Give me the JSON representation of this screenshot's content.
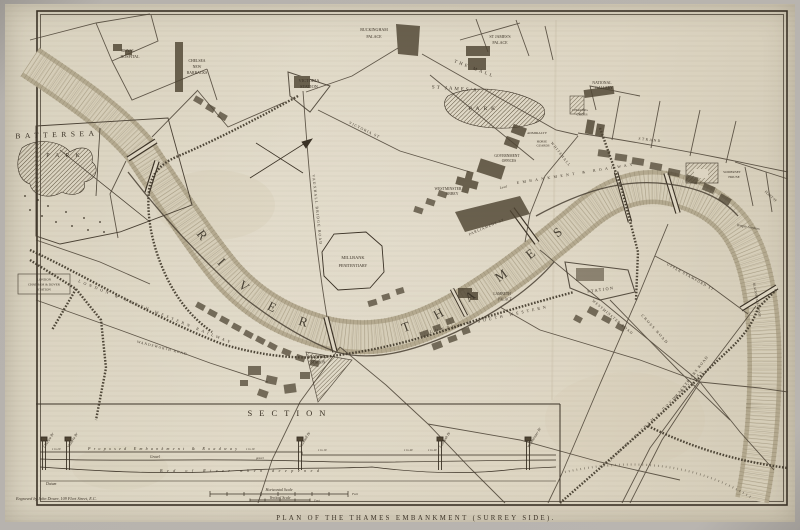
{
  "figure": {
    "caption": "PLAN OF THE THAMES EMBANKMENT (SURREY SIDE).",
    "credit": "Engraved by John Dower, 109 Fleet Street, E.C.",
    "colors": {
      "paper": "#ddd5c2",
      "ink": "#3b3226",
      "river_channel": "#d5cdb8",
      "river_bank": "#b1a68c",
      "photo_border": "#b6b2ad"
    }
  },
  "map": {
    "river_label": "RIVER THAMES",
    "labels": {
      "battersea": "BATTERSEA",
      "battersea_park": "PARK",
      "royal_hospital": [
        "ROYAL",
        "HOSPITAL"
      ],
      "chelsea_barracks": [
        "CHELSEA",
        "NEW",
        "BARRACKS"
      ],
      "victoria_station": [
        "VICTORIA",
        "STATION"
      ],
      "buckingham_palace": [
        "BUCKINGHAM",
        "PALACE"
      ],
      "st_james_palace": [
        "ST JAMES'S",
        "PALACE"
      ],
      "the_mall": "THE MALL",
      "st_james_park": [
        "ST JAMES'S",
        "PARK"
      ],
      "national_gallery": [
        "NATIONAL",
        "GALLERY"
      ],
      "charing_cross": [
        "CHARING",
        "CROSS"
      ],
      "admiralty": "ADMIRALTY",
      "horse_guards": [
        "HORSE",
        "GUARDS"
      ],
      "government_offices": [
        "GOVERNMENT",
        "OFFICES"
      ],
      "westminster_abbey": [
        "WESTMINSTER",
        "ABBEY"
      ],
      "whitehall": "WHITEHALL",
      "parliament_street": "PARLIAMENT ST",
      "victoria_street": "VICTORIA ST",
      "vauxhall_bridge_road": "VAUXHALL BRIDGE ROAD",
      "millbank_penitentiary": [
        "MILLBANK",
        "PENITENTIARY"
      ],
      "lambeth_palace": [
        "LAMBETH",
        "PALACE"
      ],
      "vauxhall_station": [
        "VAUXHALL",
        "STATION"
      ],
      "london_chatham_dover_station": [
        "LONDON",
        "CHATHAM & DOVER",
        "STATION"
      ],
      "south_western_railway_west": "LONDON & SOUTH WESTERN RAILWAY",
      "south_western_railway_east": "LONDON & SOUTH WESTERN",
      "waterloo_station": "STATION",
      "embankment_level": "Level",
      "embankment_roadway": "EMBANKMENT & ROADWAY",
      "upper_stamford_street": "UPPER STAMFORD ST",
      "cross_road": "CROSS ROAD",
      "blackfriars_road": "BLACKFRIARS ROAD",
      "blackfriars_bridge": "BLACKFRIARS BRIDGE",
      "london_chatham_dover_railway": "LONDON CHATHAM & DOVER RAILWAY",
      "somerset_house": [
        "SOMERSET",
        "HOUSE"
      ],
      "temple_gardens": "Temple Gardens",
      "strand": "STRAND",
      "fleet_street": "FLEET ST",
      "westminster_road": "WESTMINSTER ROAD",
      "wandsworth_road": "WANDSWORTH ROAD"
    }
  },
  "section": {
    "title": "SECTION",
    "bridges": [
      "Chelsea Br",
      "Victoria Br",
      "Vauxhall Br",
      "Lambeth Br",
      "Westminster Br"
    ],
    "embankment": "Proposed Embankment & Roadway",
    "gravel": "Gravel",
    "gravel_small": "gravel",
    "bed_of_river": "Bed of River when deepened",
    "datum": "Datum",
    "slopes": [
      "1 in 20",
      "1 in 10",
      "1 in 10",
      "1 in 40",
      "1 in 40"
    ],
    "horizontal_scale": "Horizontal Scale",
    "vertical_scale": "Vertical Scale",
    "feet": "Feet"
  }
}
